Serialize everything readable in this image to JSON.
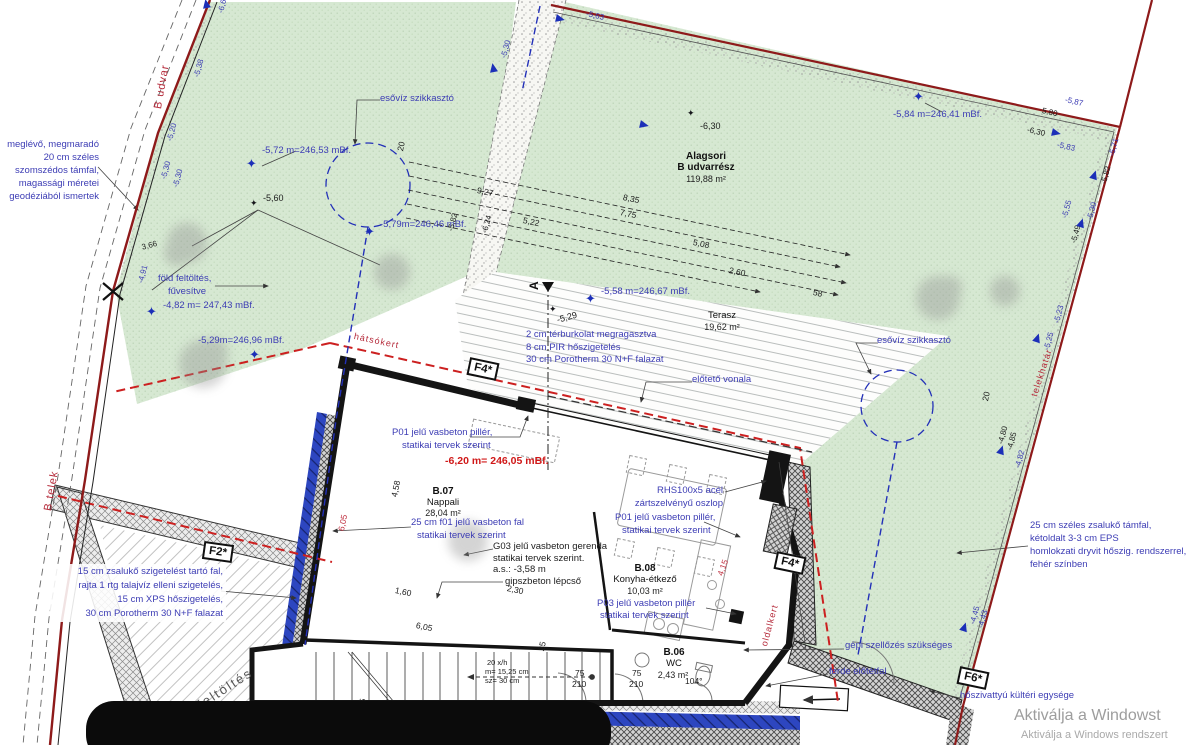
{
  "plan_areas": {
    "courtyard": {
      "name1": "Alagsori",
      "name2": "B udvarrész",
      "area": "119,88 m²"
    },
    "terrace": {
      "name": "Terasz",
      "area": "19,62 m²"
    }
  },
  "rooms": [
    {
      "id": "B.07",
      "name": "Nappali",
      "area": "28,04 m²"
    },
    {
      "id": "B.08",
      "name": "Konyha-étkező",
      "area": "10,03 m²"
    },
    {
      "id": "B.06",
      "name": "WC",
      "area": "2,43 m²"
    }
  ],
  "notes": {
    "existing_wall": [
      "meglévő, megmaradó",
      "20 cm széles",
      "szomszédos támfal,",
      "magassági méretei",
      "geodéziából ismertek"
    ],
    "earth_fill": [
      "föld feltöltés,",
      "fűvesítve"
    ],
    "soakaway": "esővíz szikkasztó",
    "terrace_layers": [
      "2 cm térburkolat megragasztva",
      "8 cm PIR hőszigetelés",
      "30 cm Porotherm 30 N+F falazat"
    ],
    "canopy": "előtető vonala",
    "pillar_p01": [
      "P01 jelű vasbeton pillér,",
      "statikai tervek szerint"
    ],
    "rhs_column": [
      "RHS100x5 acél",
      "zártszelvényű oszlop"
    ],
    "wall_f01": [
      "25 cm f01 jelű vasbeton fal",
      "statikai tervek szerint"
    ],
    "beam_g03": [
      "G03 jelű vasbeton gerenda",
      "statikai tervek szerint.",
      "a.s.: -3,58 m",
      "gipszbeton lépcső"
    ],
    "pillar_p03": [
      "P03 jelű vasbeton pillér",
      "statikai tervek szerint"
    ],
    "ventilation": "gépi szellőzés szükséges",
    "sloped_wall": "ferde előtétfal",
    "heat_pump": "hőszivattyú kültéri egysége",
    "retaining_right": [
      "25 cm széles zsalukő támfal,",
      "kétoldalt 3-3 cm EPS",
      "homlokzati dryvit hőszig. rendszerrel,",
      "fehér színben"
    ],
    "retaining_left": [
      "15 cm zsalukő szigetelést tartó fal,",
      "rajta 1 rtg talajvíz elleni szigetelés,",
      "15 cm XPS hőszigetelés,",
      "30 cm Porotherm 30 N+F falazat"
    ]
  },
  "main_elevation": "-6,20 m= 246,05 mBf.",
  "elevation_labels": [
    "-5,72 m=246,53 mBf.",
    "-5,79m=246,46 mBf.",
    "-4,82 m= 247,43 mBf.",
    "-5,29m=246,96 mBf.",
    "-5,58 m=246,67 mBf.",
    "-5,84 m=246,41 mBf.",
    "-6,30",
    "-5,60",
    "-5,29"
  ],
  "spot_elevations": [
    "-5,20",
    "-5,30",
    "-5,30",
    "-5,38",
    "-4,91",
    "3,66",
    "-5,82",
    "-6,24",
    "5,80",
    "-5,87",
    "-6,30",
    "-5,83",
    "-5,71",
    "-5,82",
    "-5,55",
    "-5,30",
    "-5,49",
    "-5,25",
    "-5,23",
    "-4,80",
    "-4,85",
    "-4,82",
    "-4,45",
    "-4,43",
    "-5,30",
    "-5,63",
    "-6,62"
  ],
  "dimensions": [
    "9,27",
    "8,35",
    "7,75",
    "5,22",
    "5,08",
    "2,60",
    "58",
    "1,60",
    "2,30",
    "6,05",
    "4,58",
    "25",
    "6,05",
    "4,15",
    "75",
    "210",
    "75",
    "210",
    "104°",
    "20",
    "20",
    "25"
  ],
  "stair_note": [
    "20 x/h",
    "m= 15,25 cm",
    "sz= 30 cm"
  ],
  "markers": [
    "F2*",
    "F4*",
    "F4*",
    "F6*"
  ],
  "boundary_labels": {
    "street": "B udvar",
    "plot": "B telek",
    "property_line": "telekhatár",
    "rear_garden": "hátsókert",
    "side_garden": "oldalkert",
    "fill": "feltöltés"
  },
  "section_marker": "A",
  "watermark": {
    "line1": "Aktiválja a Windowst",
    "line2": "Aktiválja a Windows rendszert"
  },
  "colors": {
    "annotation_blue": "#3c3cb4",
    "annotation_red": "#b52a3a",
    "boundary_red": "#8e1a1a",
    "setback_red": "#cc2020",
    "garden_green": "#d6e8d2",
    "insulation_blue": "#2d46c0",
    "elevation_red": "#d01818"
  }
}
